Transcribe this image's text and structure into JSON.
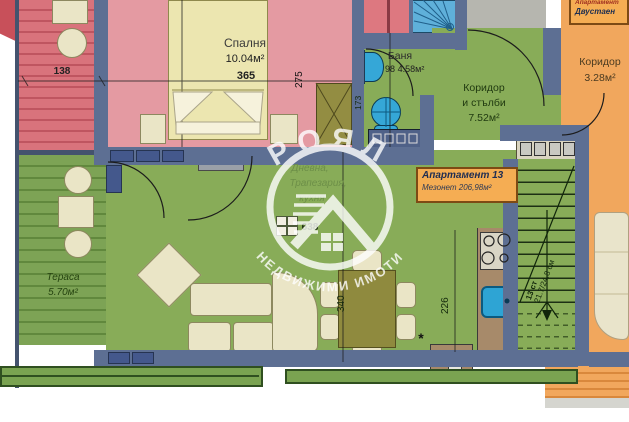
{
  "watermark": {
    "top": "РОЯЛ",
    "bottom": "НЕДВИЖИМИ ИМОТИ"
  },
  "bedroom": {
    "name": "Спалня",
    "area": "10.04м²",
    "width_dim": "365",
    "height_dim": "275"
  },
  "bathroom": {
    "name": "Баня",
    "area": "4.58м²",
    "width_dim": "98",
    "height_dim": "173"
  },
  "hall": {
    "line1": "Коридор",
    "line2": "и стълби",
    "area": "7.52м²"
  },
  "corridor_right": {
    "name": "Коридор",
    "area": "3.28м²"
  },
  "terrace_left": {
    "name": "Тераса",
    "area": "5.70м²"
  },
  "terrace_red": {
    "width_dim": "138"
  },
  "living": {
    "label1": "Дневна,",
    "label2": "Трапезария,",
    "label3": "кухня",
    "dim_main": "340",
    "dim_kitchen": "226",
    "dim_note": "638",
    "asterisk": "*"
  },
  "stairs": {
    "steps": "13 ст",
    "tread": "21.7/24.8 см"
  },
  "apartment_box": {
    "title": "Апартамент 13",
    "subtitle": "Мезонет 206,98м²"
  },
  "neighbor_box": {
    "title": "Апартамент",
    "subtitle": "Двустаен"
  },
  "colors": {
    "wall": "#5d6f93",
    "living_green": "#88ac58",
    "terrace_green": "#7aa351",
    "bedroom_pink": "#e49aa2",
    "terrace_red": "#d9737c",
    "orange": "#f1a75d",
    "shower_blue": "#5fb0da",
    "fixture_blue": "#35a7d7",
    "label_box_bg": "#f5ad53",
    "furniture_beige": "#eae5c6",
    "olive": "#8f8a3e"
  }
}
